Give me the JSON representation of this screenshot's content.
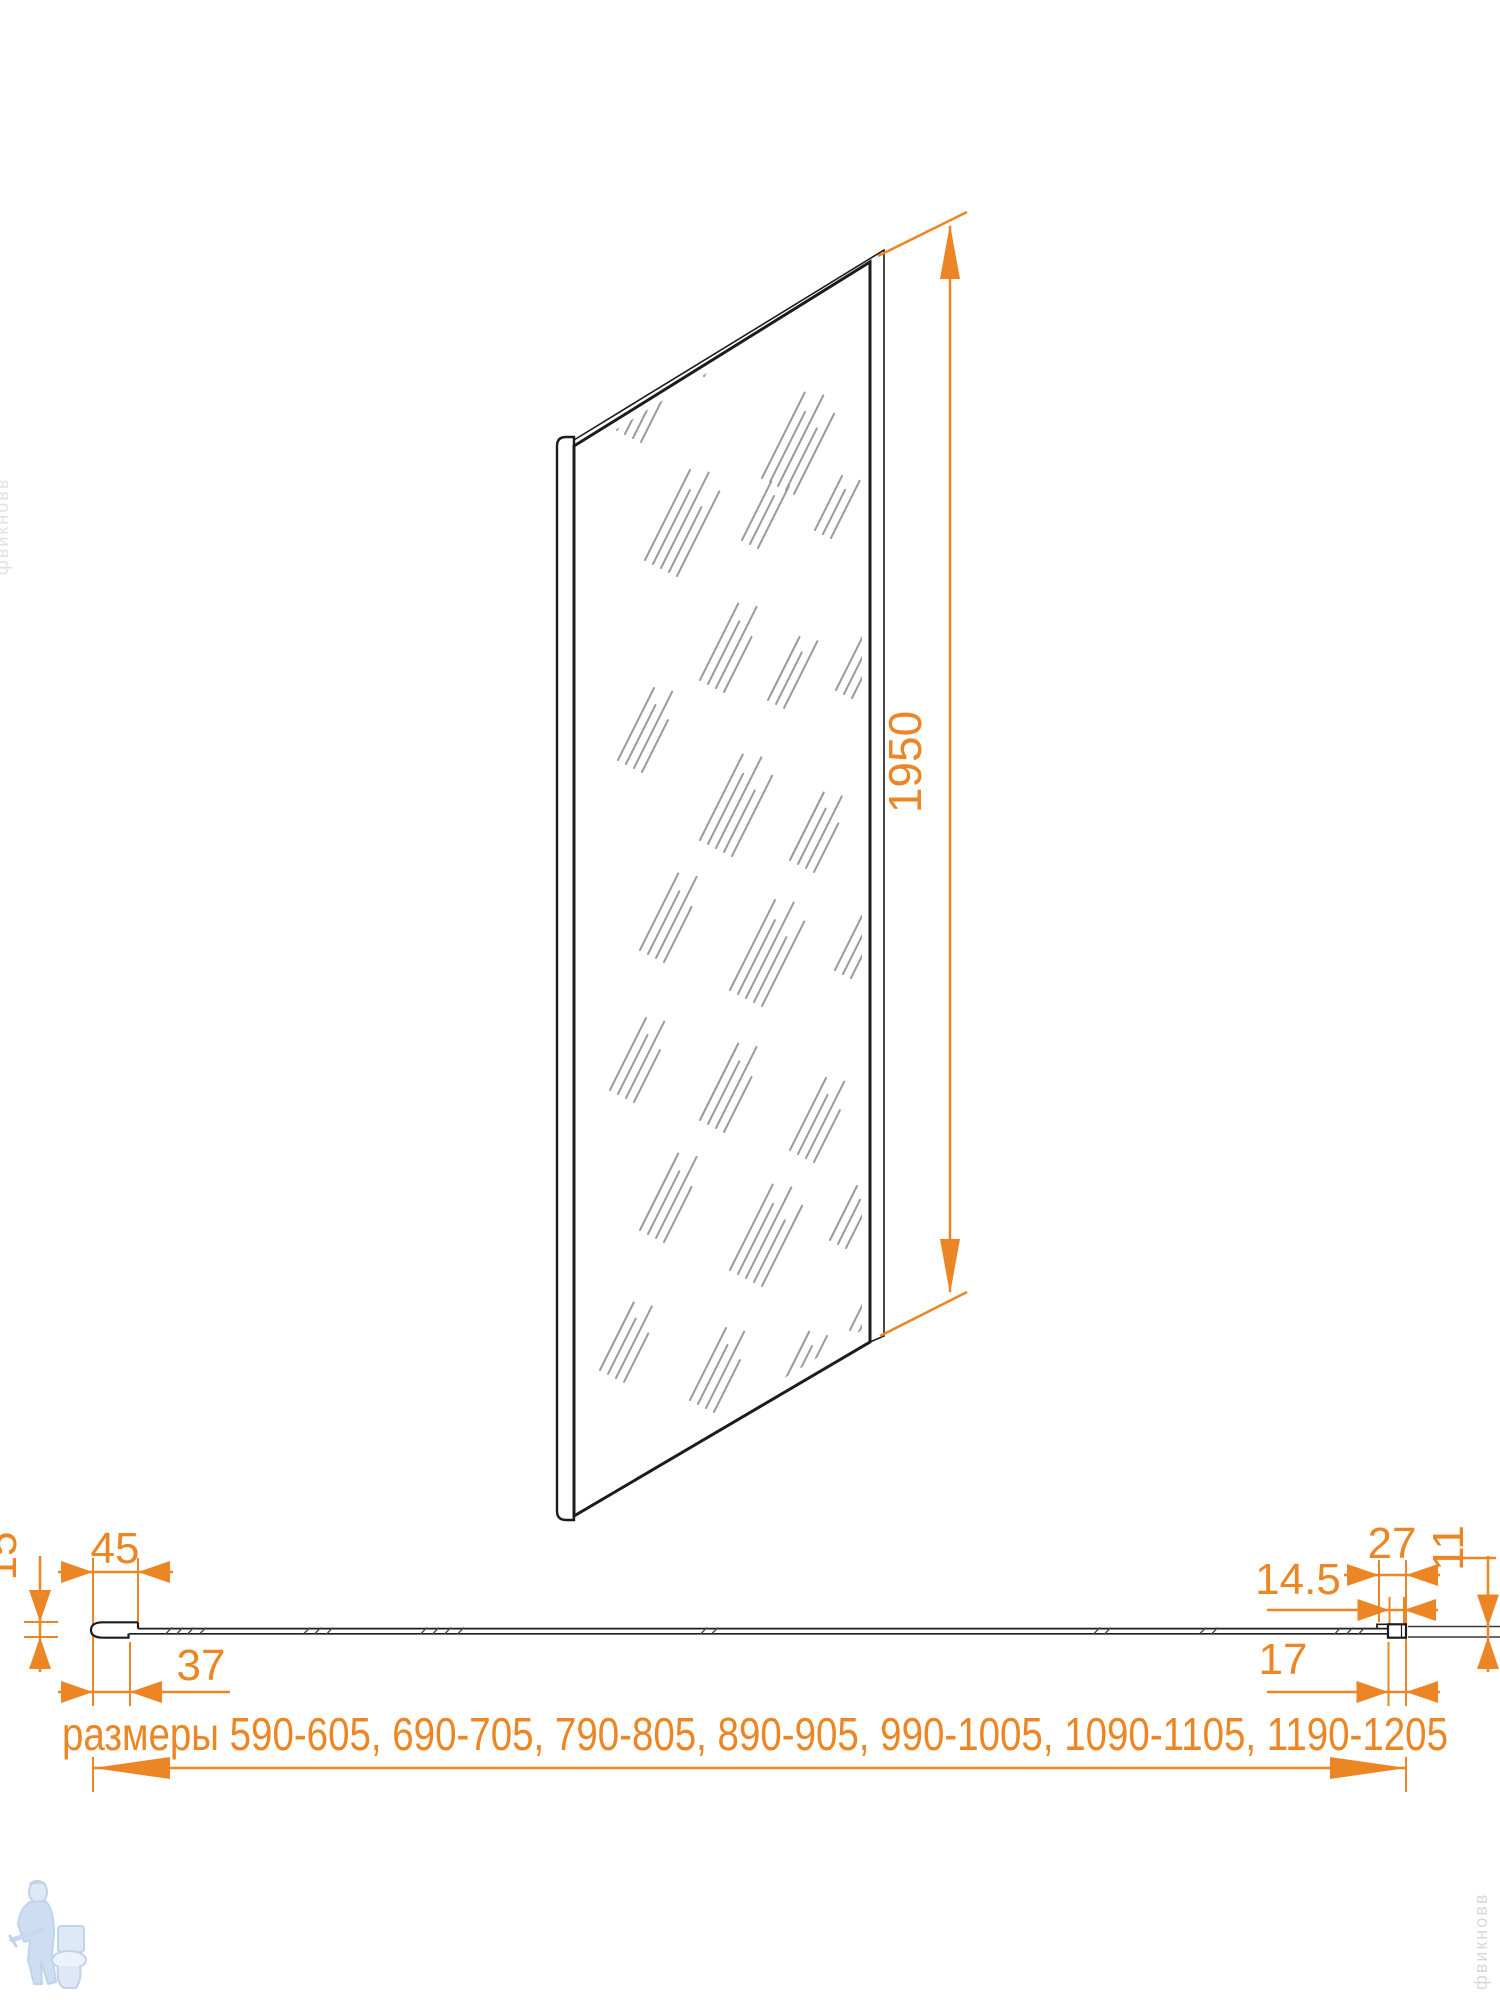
{
  "title": "Технический чертёж боковой стенки душевого ограждения",
  "colors": {
    "background": "#ffffff",
    "accent": "#ec8524",
    "line": "#1c1c1c",
    "hatch": "#9b9b9b",
    "watermark_blue": "#b9cfe8",
    "watermark_gray": "#d8d8d8"
  },
  "dims": {
    "height": "1950",
    "left_profile_width": "45",
    "left_profile_height": "15",
    "left_glass_offset": "37",
    "right_profile_width": "27",
    "right_profile_height": "11",
    "right_glass_insert": "14.5",
    "right_glass_offset": "17",
    "sizes_line": "размеры 590-605, 690-705, 790-805,  890-905, 990-1005, 1090-1105, 1190-1205"
  },
  "watermarks": {
    "plumber_logo": "plumber-with-toilet-logo",
    "vertical_text": "фвикновв"
  }
}
